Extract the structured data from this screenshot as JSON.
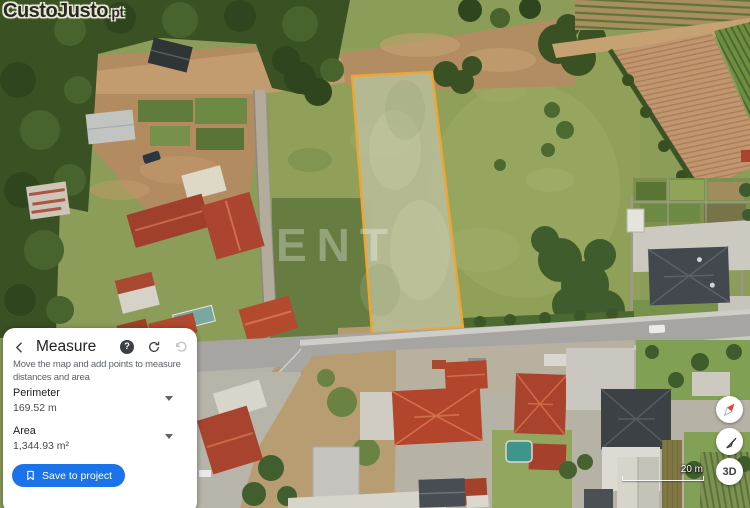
{
  "logo": {
    "brand": "CustoJusto",
    "tld": ".pt"
  },
  "map": {
    "watermark": "ENT",
    "scale_label": "20 m",
    "measured_plot": {
      "outline_color": "#efa52e",
      "fill_color": "#b6bb95"
    }
  },
  "measure_panel": {
    "title": "Measure",
    "help_glyph": "?",
    "description": "Move the map and add points to measure distances and area",
    "perimeter": {
      "label": "Perimeter",
      "value": "169.52 m"
    },
    "area": {
      "label": "Area",
      "value": "1,344.93 m²"
    },
    "save_button": "Save to project"
  },
  "map_controls": {
    "three_d_label": "3D"
  },
  "colors": {
    "accent_blue": "#1a73e8",
    "plot_outline": "#efa52e",
    "panel_bg": "#ffffff"
  }
}
